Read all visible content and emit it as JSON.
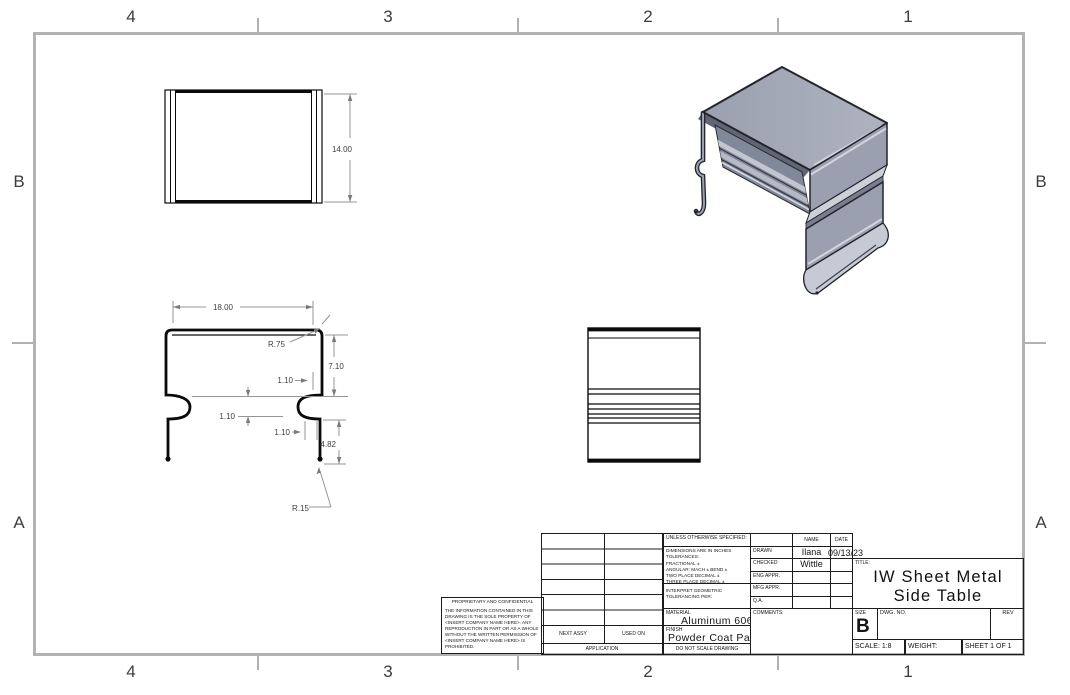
{
  "sheet": {
    "top_zones": [
      "4",
      "3",
      "2",
      "1"
    ],
    "bottom_zones": [
      "4",
      "3",
      "2",
      "1"
    ],
    "left_zones": [
      "B",
      "A"
    ],
    "right_zones": [
      "B",
      "A"
    ]
  },
  "views": {
    "front": {
      "height": "14.00"
    },
    "section": {
      "width": "18.00",
      "top_radius": "R.75",
      "upper_height": "7.10",
      "offset_a": "1.10",
      "offset_b": "1.10",
      "offset_c": "1.10",
      "lower_height": "4.82",
      "bottom_radius": "R.15"
    }
  },
  "title_block": {
    "tolerance_notes": {
      "header": "UNLESS OTHERWISE SPECIFIED:",
      "line1": "DIMENSIONS ARE IN INCHES",
      "line2": "TOLERANCES:",
      "line3": "FRACTIONAL ±",
      "line4": "ANGULAR: MACH ±  BEND ±",
      "line5": "TWO PLACE DECIMAL    ±",
      "line6": "THREE PLACE DECIMAL  ±"
    },
    "interpret_line1": "INTERPRET GEOMETRIC",
    "interpret_line2": "TOLERANCING PER:",
    "material_label": "MATERIAL",
    "material_value": "Aluminum 6061",
    "finish_label": "FINISH",
    "finish_value": "Powder Coat Paint",
    "do_not_scale": "DO NOT SCALE DRAWING",
    "name_header": "NAME",
    "date_header": "DATE",
    "rows": [
      {
        "label": "DRAWN",
        "name": "Ilana",
        "date": "09/13/23"
      },
      {
        "label": "CHECKED",
        "name": "Wittle",
        "date": ""
      },
      {
        "label": "ENG APPR.",
        "name": "",
        "date": ""
      },
      {
        "label": "MFG APPR.",
        "name": "",
        "date": ""
      },
      {
        "label": "Q.A.",
        "name": "",
        "date": ""
      }
    ],
    "comments_label": "COMMENTS:",
    "title_label": "TITLE:",
    "title_line1": "IW Sheet Metal",
    "title_line2": "Side Table",
    "size_label": "SIZE",
    "size_value": "B",
    "dwg_no_label": "DWG. NO.",
    "rev_label": "REV",
    "scale_text": "SCALE: 1:8",
    "weight_label": "WEIGHT:",
    "sheet_text": "SHEET 1 OF 1",
    "next_assy": "NEXT ASSY",
    "used_on": "USED ON",
    "application": "APPLICATION"
  },
  "proprietary": {
    "title": "PROPRIETARY AND CONFIDENTIAL",
    "body": "THE INFORMATION CONTAINED IN THIS DRAWING IS THE SOLE PROPERTY OF <INSERT COMPANY NAME HERE>. ANY REPRODUCTION IN PART OR AS A WHOLE WITHOUT THE WRITTEN PERMISSION OF <INSERT COMPANY NAME HERE> IS PROHIBITED.",
    "colors": {
      "border_gray": "#b2b2b2",
      "line_black": "#0a0a0a",
      "dim_gray": "#969696",
      "part_top": "#a6abb8",
      "part_side": "#9aa0af",
      "part_inner": "#818899",
      "part_highlight": "#ccd0d9"
    }
  }
}
